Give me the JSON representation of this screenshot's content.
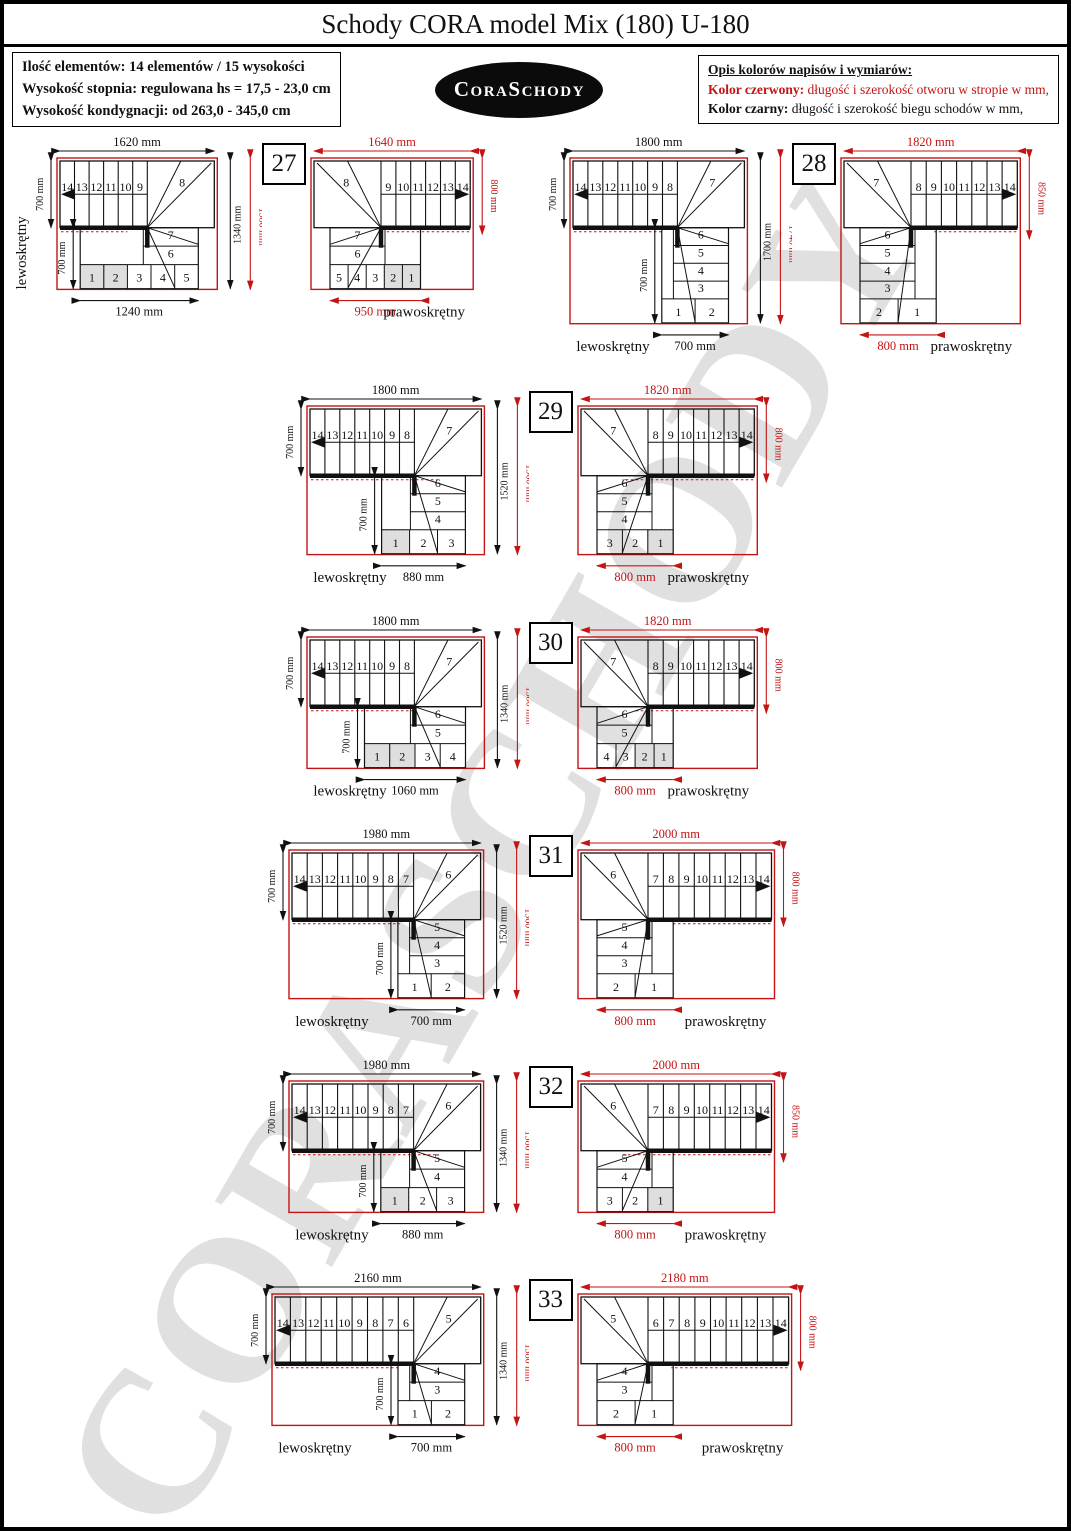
{
  "header": {
    "title": "Schody CORA model Mix (180) U-180",
    "info_lines": [
      "Ilość elementów: 14 elementów / 15 wysokości",
      "Wysokość stopnia: regulowana  hs = 17,5 - 23,0 cm",
      "Wysokość kondygnacji: od 263,0 - 345,0 cm"
    ],
    "logo_text": "CoraSchody",
    "legend_title": "Opis kolorów napisów i wymiarów:",
    "legend_red_label": "Kolor czerwony:",
    "legend_red_text": " długość i szerokość otworu w stropie w mm,",
    "legend_black_label": "Kolor czarny:",
    "legend_black_text": " długość i szerokość biegu schodów w mm,"
  },
  "labels": {
    "left": "lewoskrętny",
    "right": "prawoskrętny"
  },
  "watermark": "CORASCHODY",
  "colors": {
    "red": "#c41414",
    "black": "#111111",
    "shade": "#dedede",
    "watermark": "#b0b0b0"
  },
  "variants": [
    {
      "number": "27",
      "left": {
        "top_dim": "1620 mm",
        "left_dim": "700 mm",
        "inner_dim": "700 mm",
        "height_black": "1340 mm",
        "height_red": "1380 mm",
        "bottom_dim": "1240 mm",
        "top_steps": [
          "14",
          "13",
          "12",
          "11",
          "10",
          "9"
        ],
        "fan_step": "8",
        "col_steps": [
          "7",
          "6"
        ],
        "bottom_steps": [
          "1",
          "2",
          "3",
          "4",
          "5"
        ],
        "shaded_steps": [
          "1",
          "2"
        ]
      },
      "right": {
        "top_dim": "1640 mm",
        "side_dim": "800 mm",
        "bottom_dim": "950 mm",
        "top_steps": [
          "9",
          "10",
          "11",
          "12",
          "13",
          "14"
        ],
        "fan_step": "8",
        "col_steps": [
          "7",
          "6"
        ],
        "bottom_steps": [
          "5",
          "4",
          "3",
          "2",
          "1"
        ],
        "shaded_steps": [
          "2",
          "1"
        ]
      }
    },
    {
      "number": "28",
      "left": {
        "top_dim": "1800 mm",
        "left_dim": "700 mm",
        "inner_dim": "700 mm",
        "height_black": "1700 mm",
        "height_red": "1740 mm",
        "bottom_dim": "700 mm",
        "top_steps": [
          "14",
          "13",
          "12",
          "11",
          "10",
          "9",
          "8"
        ],
        "fan_step": "7",
        "col_steps": [
          "6",
          "5",
          "4",
          "3"
        ],
        "bottom_steps": [
          "1",
          "2"
        ],
        "shaded_steps": []
      },
      "right": {
        "top_dim": "1820 mm",
        "side_dim": "850 mm",
        "bottom_dim": "800 mm",
        "top_steps": [
          "8",
          "9",
          "10",
          "11",
          "12",
          "13",
          "14"
        ],
        "fan_step": "7",
        "col_steps": [
          "6",
          "5",
          "4",
          "3"
        ],
        "bottom_steps": [
          "2",
          "1"
        ],
        "shaded_steps": []
      }
    },
    {
      "number": "29",
      "left": {
        "top_dim": "1800 mm",
        "left_dim": "700 mm",
        "inner_dim": "700 mm",
        "height_black": "1520 mm",
        "height_red": "1560 mm",
        "bottom_dim": "880 mm",
        "top_steps": [
          "14",
          "13",
          "12",
          "11",
          "10",
          "9",
          "8"
        ],
        "fan_step": "7",
        "col_steps": [
          "6",
          "5",
          "4"
        ],
        "bottom_steps": [
          "1",
          "2",
          "3"
        ],
        "shaded_steps": [
          "1"
        ]
      },
      "right": {
        "top_dim": "1820 mm",
        "side_dim": "800 mm",
        "bottom_dim": "800 mm",
        "top_steps": [
          "8",
          "9",
          "10",
          "11",
          "12",
          "13",
          "14"
        ],
        "fan_step": "7",
        "col_steps": [
          "6",
          "5",
          "4"
        ],
        "bottom_steps": [
          "3",
          "2",
          "1"
        ],
        "shaded_steps": [
          "1"
        ]
      }
    },
    {
      "number": "30",
      "left": {
        "top_dim": "1800 mm",
        "left_dim": "700 mm",
        "inner_dim": "700 mm",
        "height_black": "1340 mm",
        "height_red": "1380 mm",
        "bottom_dim": "1060 mm",
        "top_steps": [
          "14",
          "13",
          "12",
          "11",
          "10",
          "9",
          "8"
        ],
        "fan_step": "7",
        "col_steps": [
          "6",
          "5"
        ],
        "bottom_steps": [
          "1",
          "2",
          "3",
          "4"
        ],
        "shaded_steps": [
          "1",
          "2"
        ]
      },
      "right": {
        "top_dim": "1820 mm",
        "side_dim": "800 mm",
        "bottom_dim": "800 mm",
        "top_steps": [
          "8",
          "9",
          "10",
          "11",
          "12",
          "13",
          "14"
        ],
        "fan_step": "7",
        "col_steps": [
          "6",
          "5"
        ],
        "bottom_steps": [
          "4",
          "3",
          "2",
          "1"
        ],
        "shaded_steps": [
          "2",
          "1"
        ]
      }
    },
    {
      "number": "31",
      "left": {
        "top_dim": "1980 mm",
        "left_dim": "700 mm",
        "inner_dim": "700 mm",
        "height_black": "1520 mm",
        "height_red": "1560 mm",
        "bottom_dim": "700 mm",
        "top_steps": [
          "14",
          "13",
          "12",
          "11",
          "10",
          "9",
          "8",
          "7"
        ],
        "fan_step": "6",
        "col_steps": [
          "5",
          "4",
          "3"
        ],
        "bottom_steps": [
          "1",
          "2"
        ],
        "shaded_steps": []
      },
      "right": {
        "top_dim": "2000 mm",
        "side_dim": "800 mm",
        "bottom_dim": "800 mm",
        "top_steps": [
          "7",
          "8",
          "9",
          "10",
          "11",
          "12",
          "13",
          "14"
        ],
        "fan_step": "6",
        "col_steps": [
          "5",
          "4",
          "3"
        ],
        "bottom_steps": [
          "2",
          "1"
        ],
        "shaded_steps": []
      }
    },
    {
      "number": "32",
      "left": {
        "top_dim": "1980 mm",
        "left_dim": "700 mm",
        "inner_dim": "700 mm",
        "height_black": "1340 mm",
        "height_red": "1380 mm",
        "bottom_dim": "880 mm",
        "top_steps": [
          "14",
          "13",
          "12",
          "11",
          "10",
          "9",
          "8",
          "7"
        ],
        "fan_step": "6",
        "col_steps": [
          "5",
          "4"
        ],
        "bottom_steps": [
          "1",
          "2",
          "3"
        ],
        "shaded_steps": [
          "1"
        ]
      },
      "right": {
        "top_dim": "2000 mm",
        "side_dim": "850 mm",
        "bottom_dim": "800 mm",
        "top_steps": [
          "7",
          "8",
          "9",
          "10",
          "11",
          "12",
          "13",
          "14"
        ],
        "fan_step": "6",
        "col_steps": [
          "5",
          "4"
        ],
        "bottom_steps": [
          "3",
          "2",
          "1"
        ],
        "shaded_steps": [
          "1"
        ]
      }
    },
    {
      "number": "33",
      "left": {
        "top_dim": "2160 mm",
        "left_dim": "700 mm",
        "inner_dim": "700 mm",
        "height_black": "1340 mm",
        "height_red": "1380 mm",
        "bottom_dim": "700 mm",
        "top_steps": [
          "14",
          "13",
          "12",
          "11",
          "10",
          "9",
          "8",
          "7",
          "6"
        ],
        "fan_step": "5",
        "col_steps": [
          "4",
          "3"
        ],
        "bottom_steps": [
          "1",
          "2"
        ],
        "shaded_steps": []
      },
      "right": {
        "top_dim": "2180 mm",
        "side_dim": "800 mm",
        "bottom_dim": "800 mm",
        "top_steps": [
          "6",
          "7",
          "8",
          "9",
          "10",
          "11",
          "12",
          "13",
          "14"
        ],
        "fan_step": "5",
        "col_steps": [
          "4",
          "3"
        ],
        "bottom_steps": [
          "2",
          "1"
        ],
        "shaded_steps": []
      }
    }
  ]
}
